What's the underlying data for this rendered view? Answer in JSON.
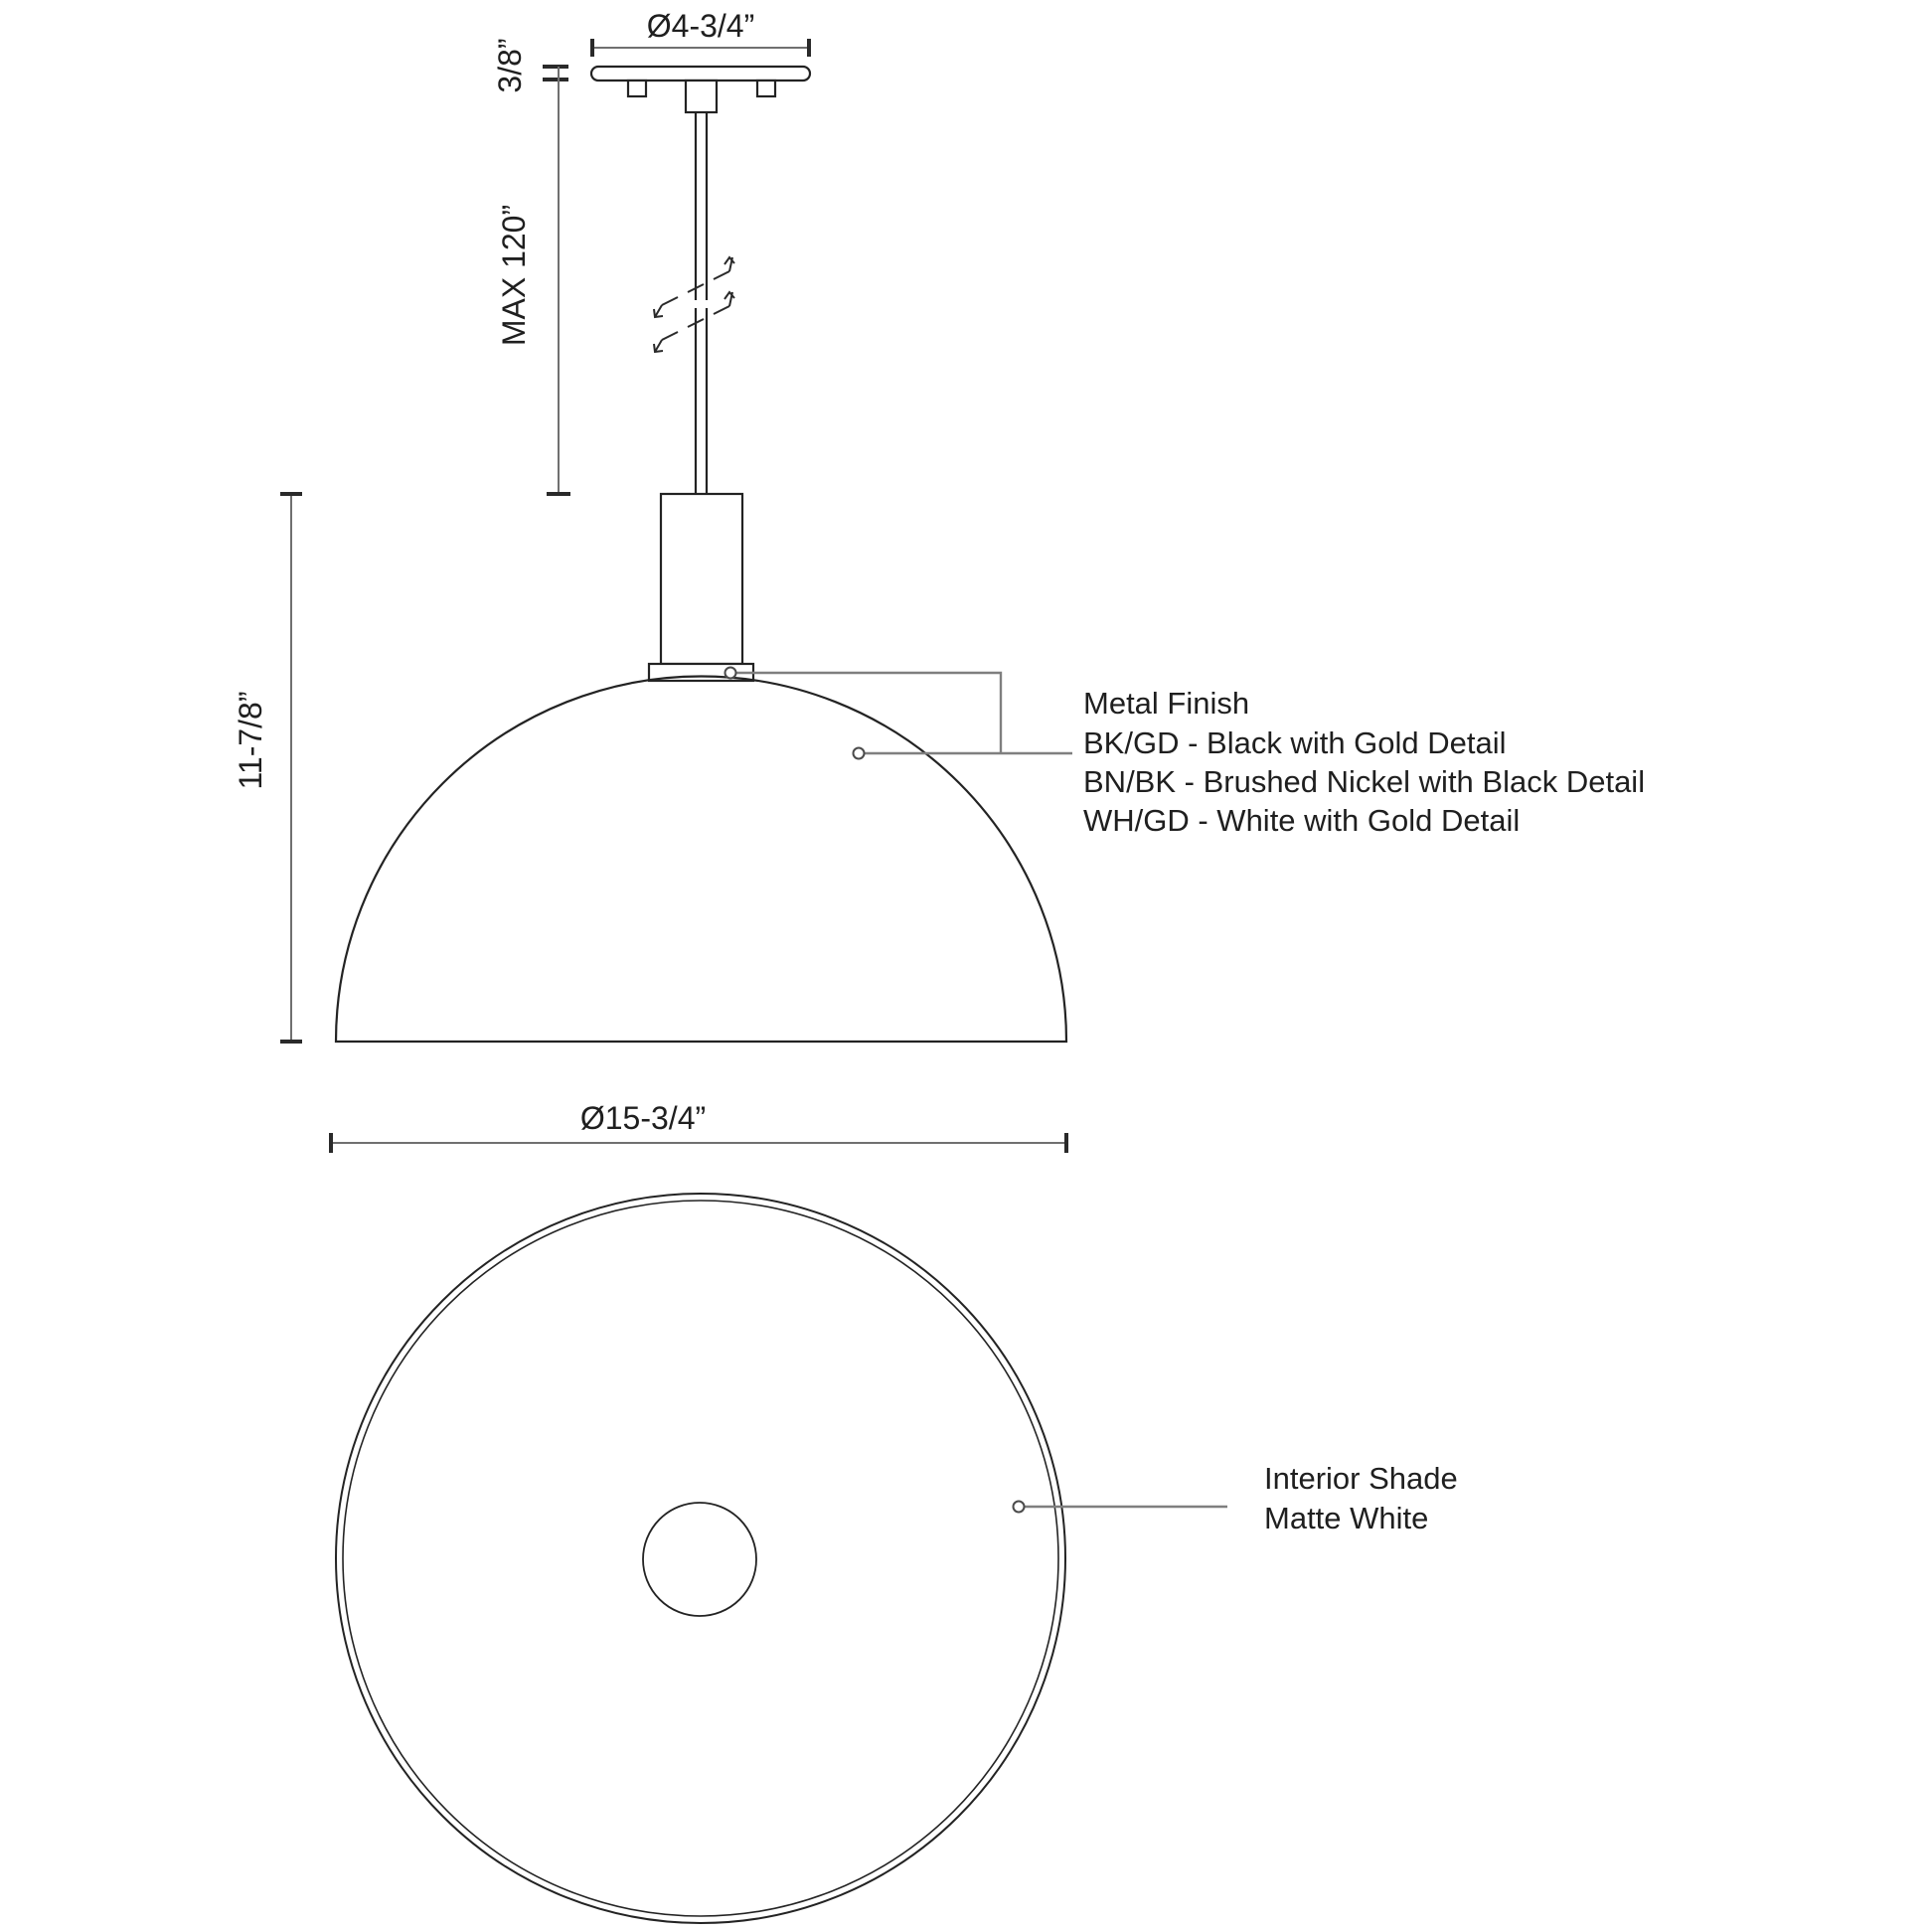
{
  "colors": {
    "background": "#ffffff",
    "object_line": "#232323",
    "dimension_line": "#707070",
    "leader_line": "#7f7f7f",
    "text": "#1f1f1f"
  },
  "side_view": {
    "canopy_diameter": "Ø4-3/4”",
    "canopy_thickness": "3/8”",
    "max_drop": "MAX 120”",
    "fixture_height": "11-7/8”",
    "shade_diameter": "Ø15-3/4”",
    "metal_finish": {
      "title": "Metal Finish",
      "options": [
        "BK/GD - Black with Gold Detail",
        "BN/BK - Brushed Nickel with Black Detail",
        "WH/GD - White with Gold Detail"
      ]
    }
  },
  "bottom_view": {
    "interior_shade_line1": "Interior Shade",
    "interior_shade_line2": "Matte White"
  }
}
